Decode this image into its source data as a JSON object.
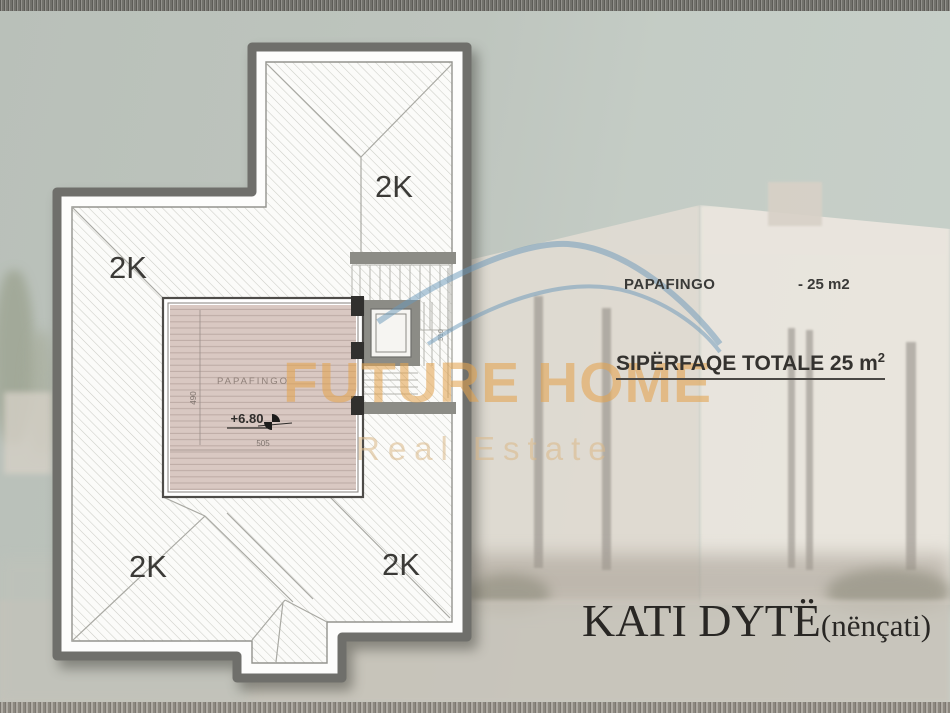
{
  "plan": {
    "roof_labels": {
      "top_left": "2K",
      "top_right": "2K",
      "bottom_left": "2K",
      "bottom_right": "2K"
    },
    "room": {
      "name": "PAPAFINGO",
      "elevation": "+6.80",
      "dim_width": "505",
      "dim_height": "490",
      "dim_stairs": "510"
    }
  },
  "legend": {
    "room_label": "PAPAFINGO",
    "room_area": "- 25 m2",
    "total_label": "SIPËRFAQE TOTALE 25 m",
    "total_sup": "2"
  },
  "watermark": {
    "brand": "FUTURE HOME",
    "tagline": "Real Estate"
  },
  "title": {
    "main": "KATI DYTË",
    "sub": "(nënçati)"
  },
  "colors": {
    "watermark_orange": "#e2a452",
    "watermark_blue": "#6a98ba",
    "outline_gray": "#6f6f6b",
    "roof_label": "#3b3a37",
    "floor_fill": "#d9c8c2"
  }
}
